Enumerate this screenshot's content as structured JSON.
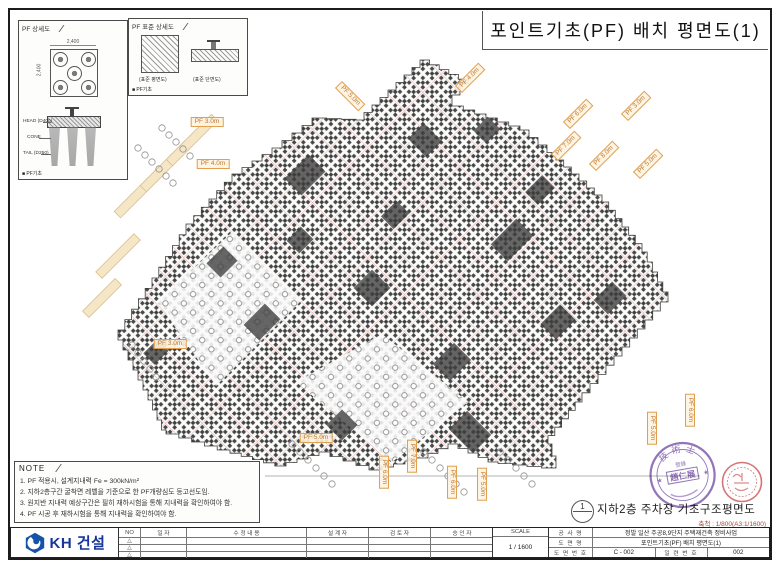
{
  "sheet": {
    "title": "포인트기초(PF) 배치 평면도(1)",
    "drawing_caption": {
      "bubble_number": "1",
      "label": "지하2층 주차장 기초구조평면도",
      "scale_note": "축척 : 1/800(A3:1/1600)"
    }
  },
  "legend_pf_detail": {
    "header": "PF 상세도",
    "dim_top": "2,400",
    "dim_left": "2,400",
    "labels": {
      "head": "HEAD (D400)",
      "cone": "CONE",
      "tail": "TAIL (D250)"
    },
    "tag": "■ PF기초"
  },
  "legend_pf_standard": {
    "header": "PF 표준 상세도",
    "caption_plan": "(표준 평면도)",
    "caption_section": "(표준 단면도)",
    "tag": "■ PF기초"
  },
  "note": {
    "header": "NOTE",
    "lines": [
      "1. PF 적용시, 설계지내력 Fe = 300kN/m²",
      "2. 지하2층구간 굴착면 레벨을 기준으로 한 PF개량심도 등고선도임.",
      "3. 원지반 지내력 예상구간은 필히 재하시험을 통해 지내력을 확인하여야 함.",
      "4. PF 시공 후 재하시험을 통해 지내력을 확인하여야 함."
    ]
  },
  "plan": {
    "depth_labels": [
      {
        "text": "PF 3.0m",
        "x": 207,
        "y": 122,
        "rot": 0
      },
      {
        "text": "PF 4.0m",
        "x": 213,
        "y": 164,
        "rot": 0
      },
      {
        "text": "PF 3.0m",
        "x": 170,
        "y": 344,
        "rot": 0
      },
      {
        "text": "PF 5.0m",
        "x": 316,
        "y": 438,
        "rot": 0
      },
      {
        "text": "PF 6.0m",
        "x": 578,
        "y": 114,
        "rot": -45
      },
      {
        "text": "PF 7.0m",
        "x": 566,
        "y": 146,
        "rot": -45
      },
      {
        "text": "PF 8.0m",
        "x": 604,
        "y": 156,
        "rot": -45
      },
      {
        "text": "PF 5.0m",
        "x": 648,
        "y": 164,
        "rot": -45
      },
      {
        "text": "PF 3.0m",
        "x": 636,
        "y": 106,
        "rot": -45
      },
      {
        "text": "PF 4.0m",
        "x": 470,
        "y": 78,
        "rot": -45
      },
      {
        "text": "PF 5.0m",
        "x": 350,
        "y": 96,
        "rot": 45
      },
      {
        "text": "PF 6.0m",
        "x": 384,
        "y": 472,
        "rot": 90
      },
      {
        "text": "PF 7.0m",
        "x": 412,
        "y": 456,
        "rot": 90
      },
      {
        "text": "PF 6.0m",
        "x": 452,
        "y": 482,
        "rot": 90
      },
      {
        "text": "PF 5.0m",
        "x": 482,
        "y": 484,
        "rot": 90
      },
      {
        "text": "PF 5.0m",
        "x": 652,
        "y": 428,
        "rot": 90
      },
      {
        "text": "PF 6.0m",
        "x": 690,
        "y": 410,
        "rot": 90
      }
    ]
  },
  "stamps": {
    "engineer_seal": {
      "ring_text": "技術士",
      "registration": "登錄",
      "name": "趙仁展",
      "star_left": "★",
      "star_right": "★"
    }
  },
  "title_block": {
    "logo_text": "KH 건설",
    "rev_headers": [
      "NO",
      "일 자",
      "수 정 내 용",
      "설 계 자",
      "검 토 자",
      "승 인 자"
    ],
    "rev_marker": "△",
    "scale_label": "SCALE",
    "scale_value": "1 / 1600",
    "fields": {
      "project_label": "공 사 명",
      "project": "정발 일산 주공8,9단지 주택재건축 정비사업",
      "drawing_label": "도 면 명",
      "drawing": "포인트기초(PF) 배치 평면도(1)",
      "dwg_no_label": "도 면 번 호",
      "dwg_no": "C - 002",
      "serial_label": "일 련 번 호",
      "serial": "002"
    }
  }
}
